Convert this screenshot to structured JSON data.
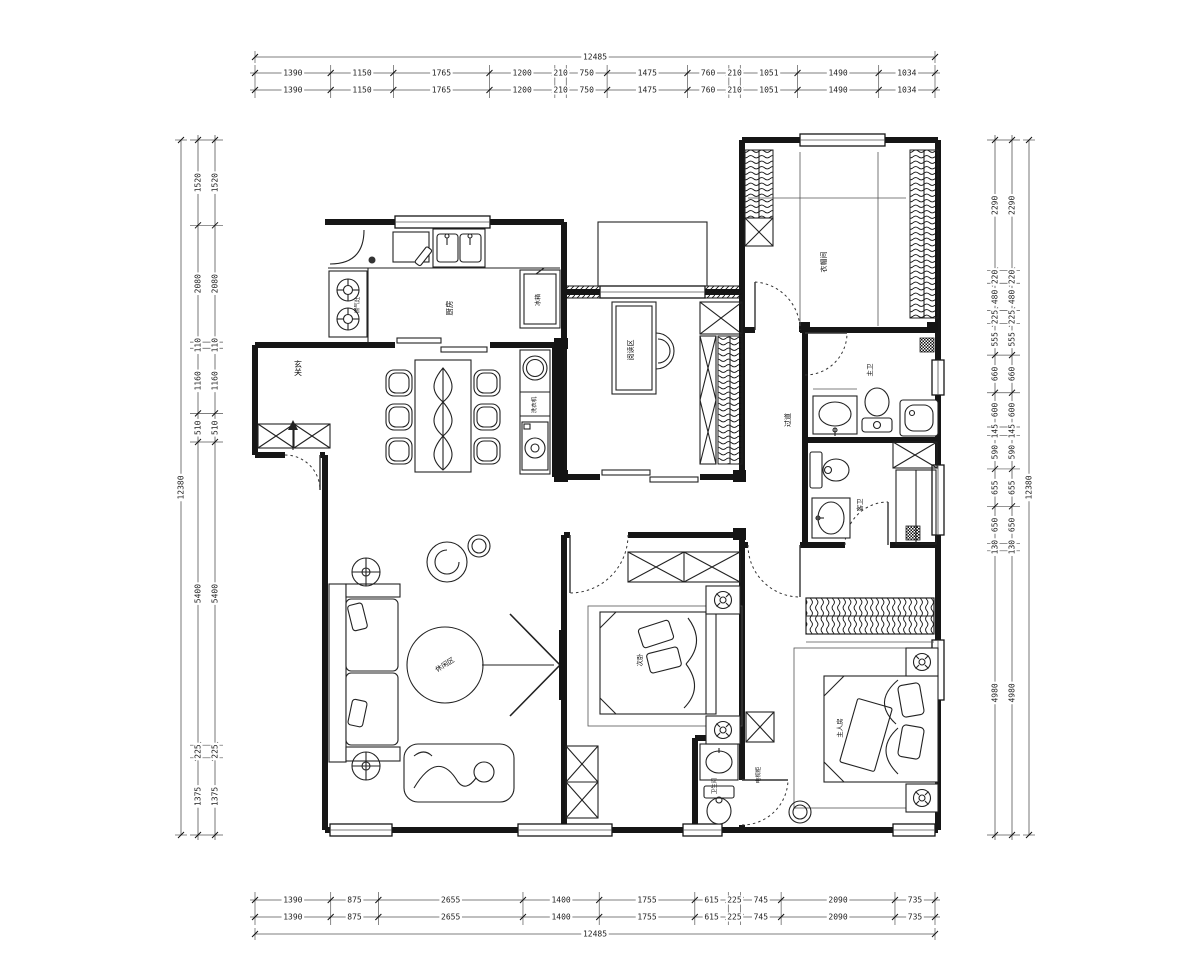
{
  "dims": {
    "top": {
      "total": "12485",
      "segments": [
        "1390",
        "1150",
        "1765",
        "1200",
        "210",
        "750",
        "1475",
        "760",
        "210",
        "1051",
        "1490",
        "1034"
      ]
    },
    "bottom": {
      "total": "12485",
      "segments": [
        "1390",
        "875",
        "2655",
        "1400",
        "1755",
        "615",
        "225",
        "745",
        "2090",
        "735"
      ]
    },
    "left": {
      "total": "12380",
      "segments": [
        "1520",
        "2080",
        "110",
        "1160",
        "510",
        "5400",
        "225",
        "1375"
      ]
    },
    "right": {
      "total": "12380",
      "segments": [
        "2290",
        "220",
        "480",
        "225",
        "555",
        "660",
        "600",
        "145",
        "590",
        "655",
        "650",
        "130",
        "4980"
      ]
    }
  },
  "rooms": {
    "entry": "玄关",
    "kitchen": "厨房",
    "fridge": "冰箱",
    "stove": "燃气灶",
    "laundry": "洗衣机",
    "study": "阅读区",
    "cloakroom": "衣帽间",
    "hallway": "过道",
    "bath_master": "主卫",
    "bath_guest": "客卫",
    "living": "休闲区",
    "bedroom2": "次卧",
    "master": "主人房",
    "tv_cabinet": "电视柜",
    "small_bath": "卫生间"
  }
}
